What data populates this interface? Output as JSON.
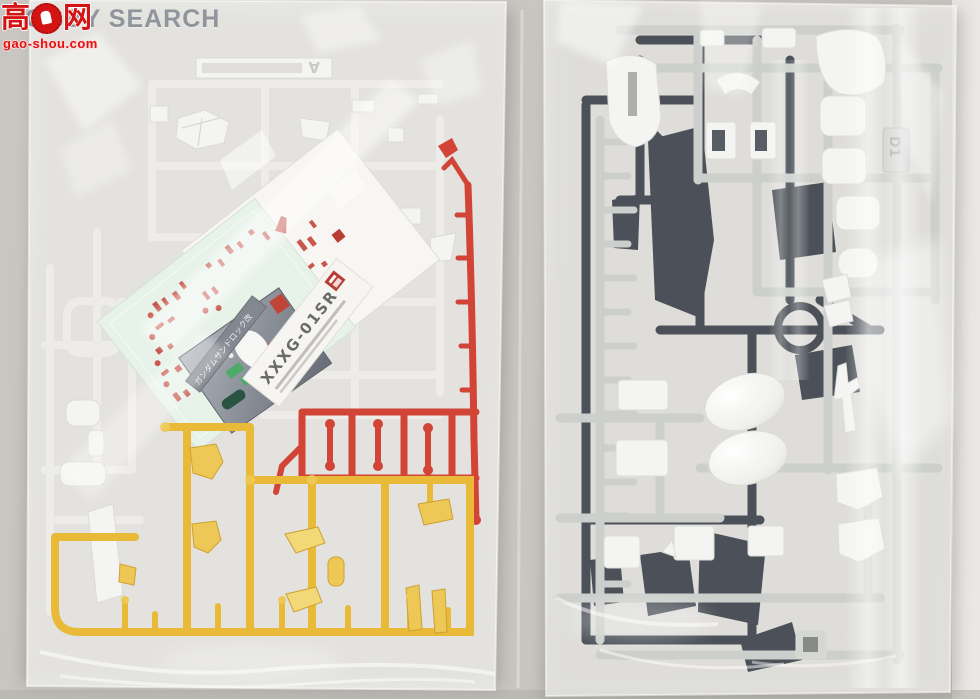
{
  "watermark": {
    "brand": "HOBBY SEARCH",
    "cn_left": "高",
    "cn_right": "网",
    "url": "gao-shou.com"
  },
  "labels": {
    "left_sprue_letter": "A",
    "right_sprue_tag": "D1",
    "decal_model_code": "XXXG-01SR",
    "decal_model_name": "ガンダムサンドロック改"
  },
  "colors": {
    "background": "#c9c6c1",
    "scan_strip": "#eae8e4",
    "bag_film": "#ededea",
    "white_sprue": "#eceae6",
    "white_parts": "#f3f3f1",
    "light_gray_runner": "#c8cbc7",
    "dark_sprue": "#3d434b",
    "red_sprue": "#cc2f20",
    "yellow_sprue": "#e7b321",
    "yellow_part": "#ecc243",
    "decal_mint": "#e5f1e7",
    "decal_red": "#c2443a",
    "foil_dark": "#60666f",
    "watermark_gray": "#767c88",
    "watermark_red": "#d41414"
  }
}
